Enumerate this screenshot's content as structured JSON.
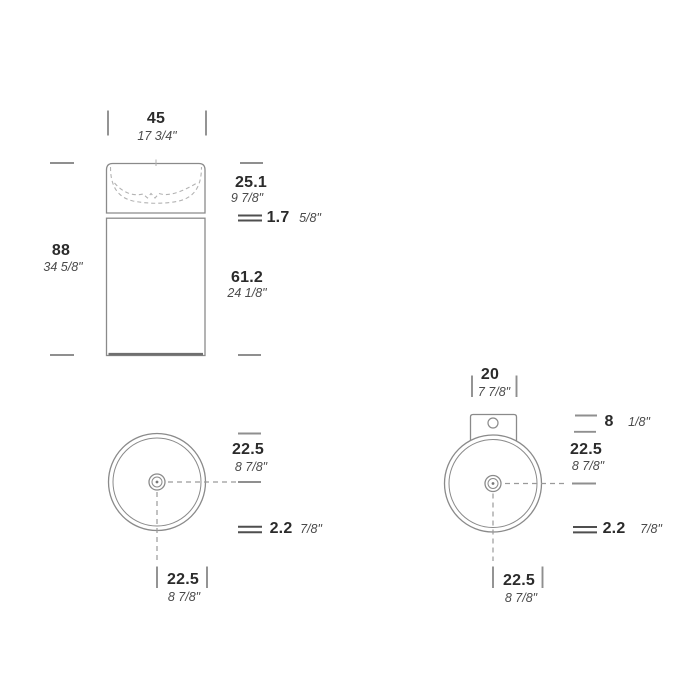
{
  "palette": {
    "background": "#ffffff",
    "outline": "#8a8a8a",
    "hidden_line": "#b3b3b3",
    "centerline": "#9a9a9a",
    "tick": "#8f8f8f",
    "thickness_mark": "#4f4f4f",
    "metric_text": "#2b2b2b",
    "imperial_text": "#4a4a4a"
  },
  "front_view": {
    "width_cm": "45",
    "width_in": "17 3/4\"",
    "height_cm": "88",
    "height_in": "34 5/8\"",
    "basin_depth_cm": "25.1",
    "basin_depth_in": "9 7/8\"",
    "rim_cm": "1.7",
    "rim_in": "5/8\"",
    "pedestal_cm": "61.2",
    "pedestal_in": "24 1/8\""
  },
  "top_view_left": {
    "center_back_cm": "22.5",
    "center_back_in": "8 7/8\"",
    "wall_cm": "2.2",
    "wall_in": "7/8\"",
    "center_side_cm": "22.5",
    "center_side_in": "8 7/8\""
  },
  "top_view_right": {
    "bracket_width_cm": "20",
    "bracket_width_in": "7 7/8\"",
    "bracket_depth_cm": "8",
    "bracket_depth_in": "1/8\"",
    "center_back_cm": "22.5",
    "center_back_in": "8 7/8\"",
    "wall_cm": "2.2",
    "wall_in": "7/8\"",
    "center_side_cm": "22.5",
    "center_side_in": "8 7/8\""
  }
}
